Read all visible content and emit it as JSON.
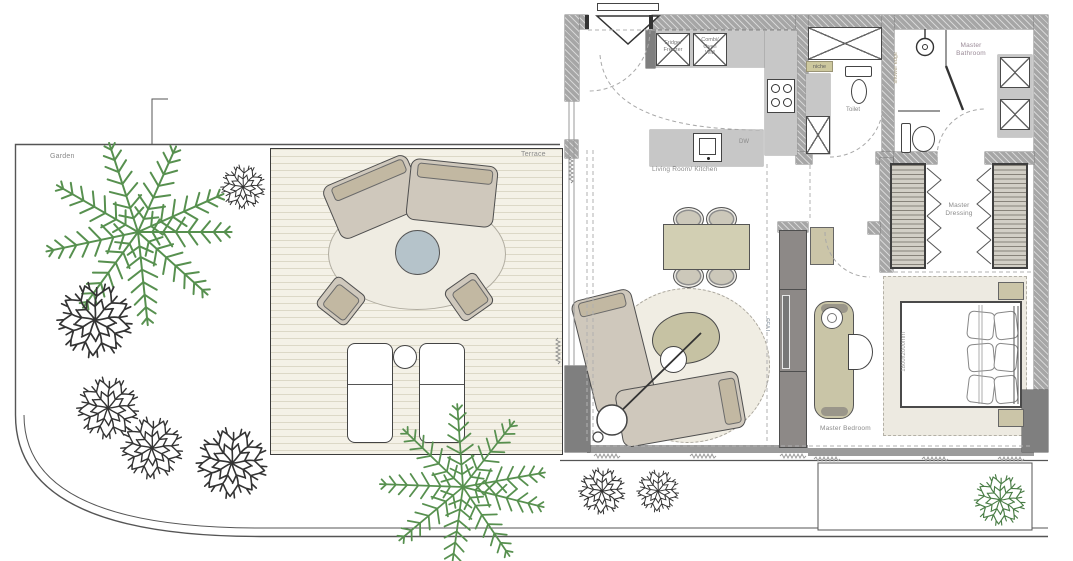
{
  "meta": {
    "title": "Apartment floor plan with garden and terrace"
  },
  "colors": {
    "wall_grey": "#a6a6a6",
    "counter_grey": "#c7c7c7",
    "furniture_tan": "#cbc5a8",
    "sofa_beige": "#cfc8bc",
    "deck_cream": "#f4f1e7",
    "rug_cream": "#f0ede3",
    "table_blue": "#b5c3ca",
    "plant_green": "#57904f",
    "label_grey": "#8a8a8a",
    "bathroom_label": "#9a8a97",
    "niche_olive": "#cdc89e",
    "dark_unit": "#8d8987"
  },
  "outdoor": {
    "garden_label": "Garden",
    "terrace_label": "Terrace"
  },
  "kitchen": {
    "room_label": "Living Room/ Kitchen",
    "dw_label": "DW",
    "fridge_line1": "Fridge/",
    "fridge_line2": "Freezer",
    "oven_line1": "Combi/",
    "oven_line2": "Oven",
    "oven_line3": "WM",
    "niche_label": "niche"
  },
  "toilet": {
    "label": "Toilet"
  },
  "bathroom": {
    "label_line1": "Master",
    "label_line2": "Bathroom",
    "shower_edge_label": "shower edge"
  },
  "dressing": {
    "label_line1": "Master",
    "label_line2": "Dressing"
  },
  "bedroom": {
    "label": "Master Bedroom",
    "bed_size_label": "1800x2000mm"
  },
  "living": {
    "tv_label": "TV55\""
  }
}
